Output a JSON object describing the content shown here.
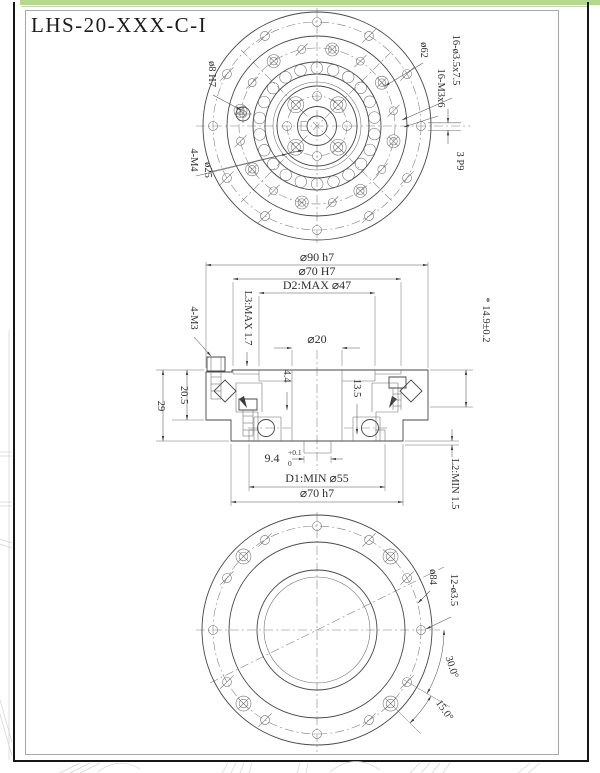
{
  "page": {
    "title": "LHS-20-XXX-C-I"
  },
  "colors": {
    "accent_green": "#b5d88c",
    "ink": "#474747",
    "frame": "#161616"
  },
  "top_view": {
    "labels": {
      "pin_hole": "ø8 H7",
      "screws": "4-M4",
      "screw_circle": "ø25",
      "bolt_circle": "ø62",
      "counterbore_holes": "16-ø3.5x7.5",
      "threaded_holes": "16-M3x6",
      "keyway": "3 P9"
    }
  },
  "section_view": {
    "labels": {
      "outer_dia": "⌀90 h7",
      "pilot_dia": "⌀70 H7",
      "d2": "D2:MAX ⌀47",
      "bore": "⌀20",
      "l3": "L3:MAX 1.7",
      "screws": "4-M3",
      "flange_height": "20.5",
      "total_height": "29",
      "step1": "4.4",
      "step2": "13.5",
      "depth": "9.4",
      "depth_tol_upper": "+0.1",
      "depth_tol_lower": "0",
      "d1": "D1:MIN ⌀55",
      "bottom_pilot": "⌀70 h7",
      "l2": "L2:MIN 1.5",
      "mount_height": "* 14.9±0.2"
    }
  },
  "bottom_view": {
    "labels": {
      "bolt_circle": "ø84",
      "holes": "12-ø3.5",
      "angle_30": "30.0°",
      "angle_15": "15.0°"
    }
  }
}
